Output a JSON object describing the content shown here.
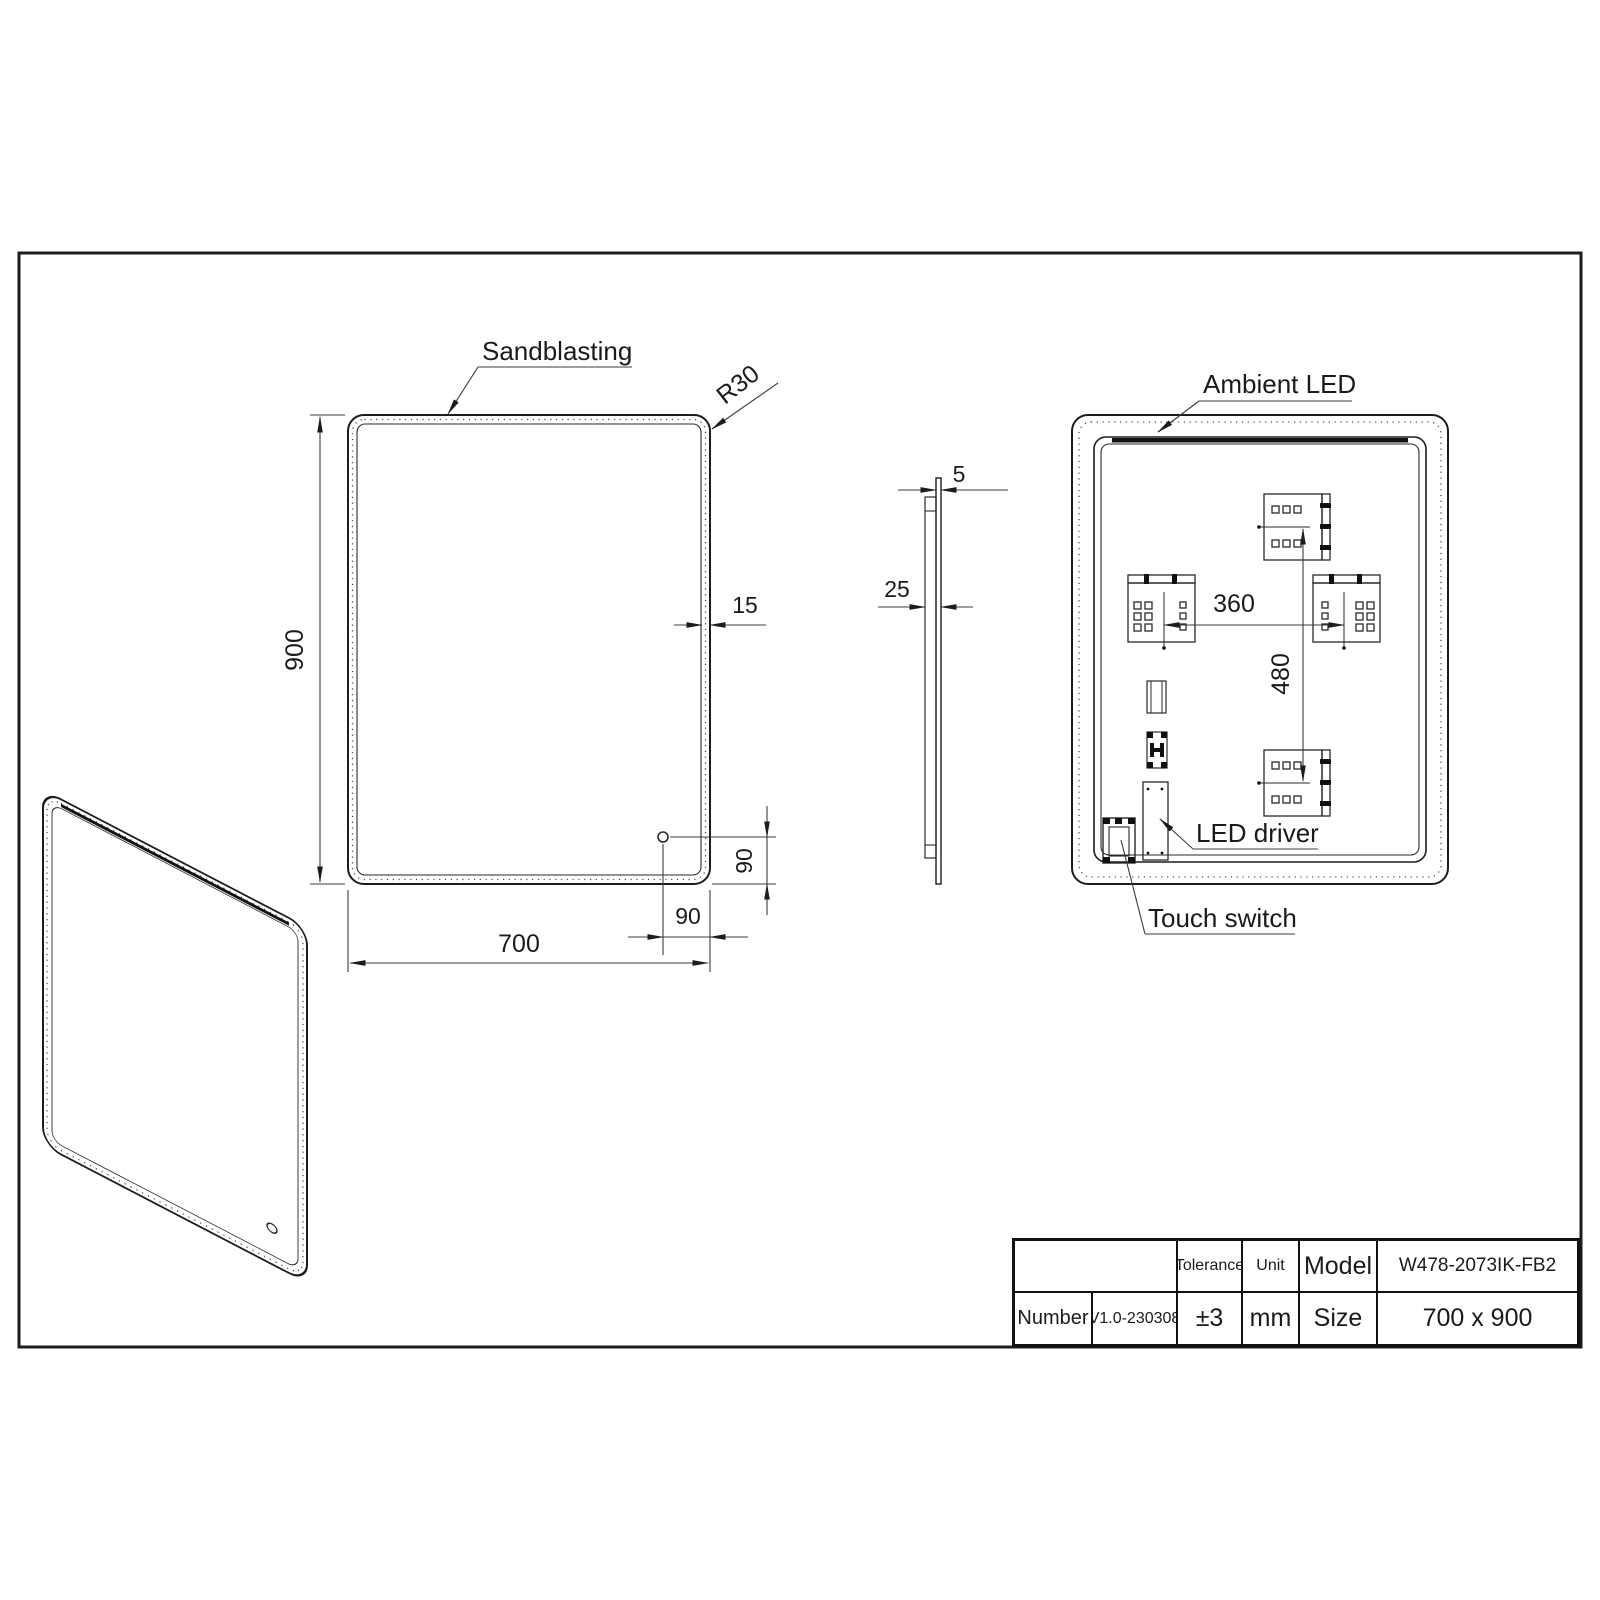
{
  "front_view": {
    "sandblasting_label": "Sandblasting",
    "corner_radius_label": "R30",
    "height_dim": "900",
    "width_dim": "700",
    "frost_band_dim": "15",
    "sensor_offset_x_dim": "90",
    "sensor_offset_y_dim": "90"
  },
  "side_view": {
    "glass_thickness_dim": "5",
    "total_depth_dim": "25"
  },
  "rear_view": {
    "ambient_led_label": "Ambient LED",
    "led_driver_label": "LED driver",
    "touch_switch_label": "Touch switch",
    "bracket_spacing_h_dim": "360",
    "bracket_spacing_v_dim": "480"
  },
  "title_block": {
    "tolerance_header": "Tolerance",
    "unit_header": "Unit",
    "model_header": "Model",
    "number_header": "Number",
    "size_header": "Size",
    "model_value": "W478-2073IK-FB2",
    "number_value": "V1.0-230308",
    "tolerance_value": "±3",
    "unit_value": "mm",
    "size_value": "700 x 900"
  }
}
